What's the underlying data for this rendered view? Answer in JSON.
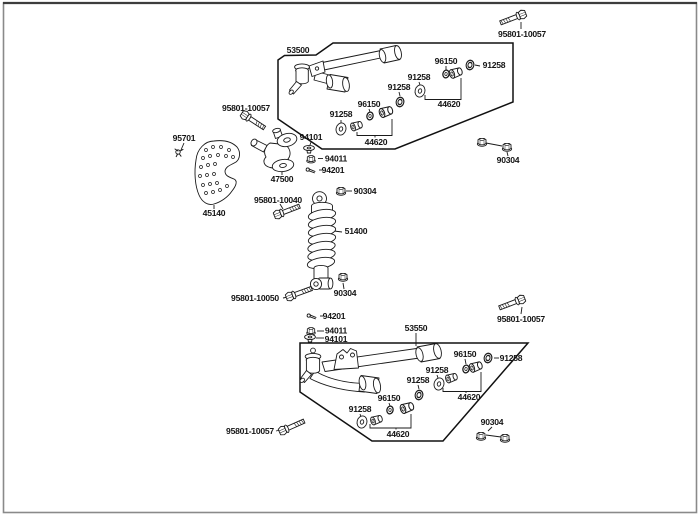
{
  "page": {
    "background": "#ffffff",
    "frame_border_color": "#8a8a8a",
    "frame_border_top_color": "#3d3d3d",
    "line_color": "#1a1a1a"
  },
  "diagram": {
    "labels": {
      "bolt_top_right": "95801-10057",
      "upper_arm": "53500",
      "upper_washer_left": "91258",
      "upper_seal_left": "96150",
      "upper_grommet_center": "91258",
      "upper_collar_left": "44620",
      "upper_washer_right": "91258",
      "upper_seal_right": "96150",
      "upper_grommet_right": "91258",
      "upper_collar_right": "44620",
      "nut_pair_right": "90304",
      "bolt_mid_left": "95801-10057",
      "retainer_clip": "95701",
      "washer_upper": "94101",
      "nut_upper": "94011",
      "pin_upper": "94201",
      "knuckle": "47500",
      "disc_cover": "45140",
      "nut_shock_top": "90304",
      "bolt_shock_top": "95801-10040",
      "shock_absorber": "51400",
      "nut_shock_bottom": "90304",
      "bolt_shock_bottom": "95801-10050",
      "pin_lower": "94201",
      "nut_lower": "94011",
      "washer_lower": "94101",
      "lower_arm": "53550",
      "bolt_bottom_right": "95801-10057",
      "lower_washer_right": "91258",
      "lower_seal_right": "96150",
      "lower_grommet_right": "91258",
      "lower_collar_right": "44620",
      "lower_grommet_center": "91258",
      "lower_seal_left": "96150",
      "lower_washer_left": "91258",
      "lower_collar_left": "44620",
      "nut_pair_bottom": "90304",
      "bolt_bottom_left": "95801-10057"
    }
  }
}
